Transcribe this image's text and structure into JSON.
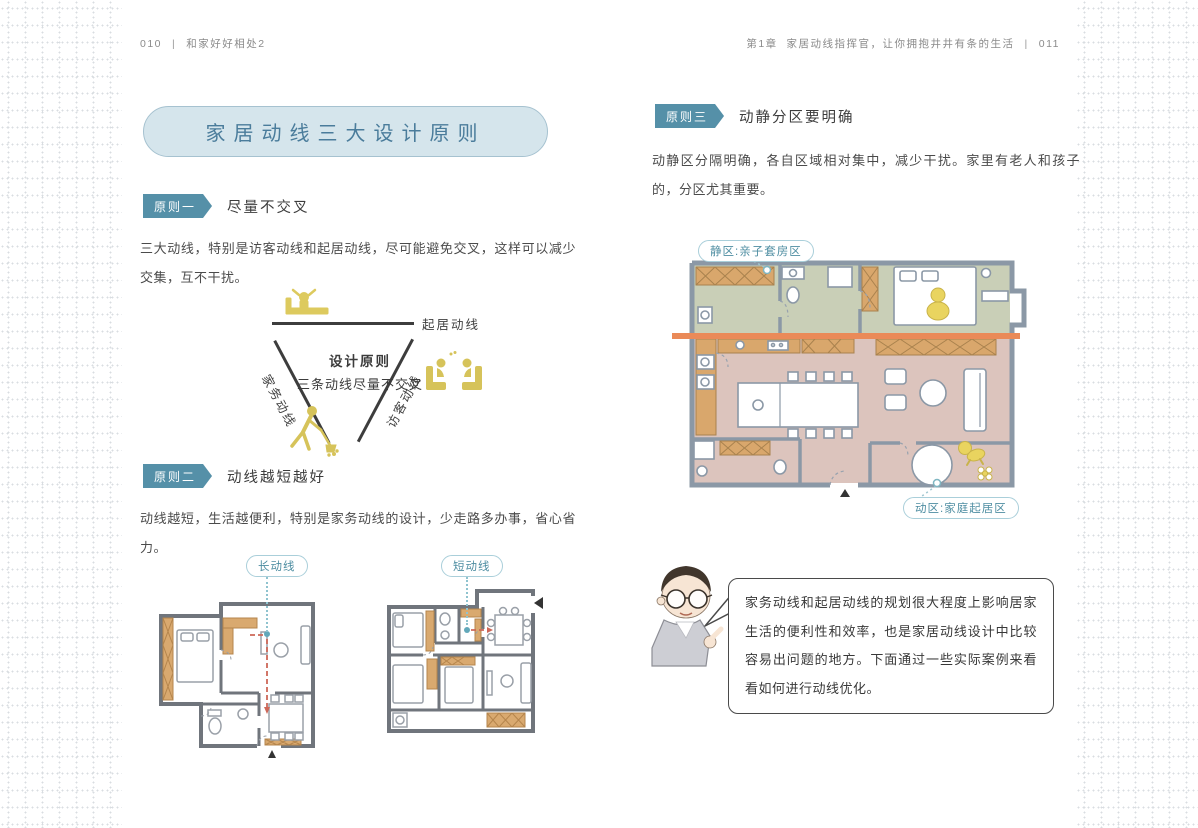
{
  "colors": {
    "accent_teal": "#5590a8",
    "title_bubble_fill": "#d5e5ec",
    "title_text": "#4a7c9b",
    "tag_teal": "#4f8ea2",
    "orange_divider": "#ea8a58",
    "quiet_zone_green": "#c9cfb7",
    "active_zone_pink": "#dcc4bd",
    "route_red": "#cd6758",
    "figure_yellow": "#ddca5e",
    "furniture_tan": "#d9a96f",
    "wall_gray": "#8b98a6"
  },
  "left_page": {
    "header": {
      "page_num": "010",
      "separator": "|",
      "book_title": "和家好好相处2"
    },
    "title": "家居动线三大设计原则",
    "sections": [
      {
        "badge": "原则一",
        "title": "尽量不交叉",
        "body": "三大动线，特别是访客动线和起居动线，尽可能避免交叉，这样可以减少交集，互不干扰。"
      },
      {
        "badge": "原则二",
        "title": "动线越短越好",
        "body": "动线越短，生活越便利，特别是家务动线的设计，少走路多办事，省心省力。"
      }
    ],
    "triangle_diagram": {
      "top_label": "起居动线",
      "left_label": "家务动线",
      "right_label": "访客动线",
      "center_title": "设计原则",
      "center_subtitle": "三条动线尽量不交叉"
    },
    "floorplans": [
      {
        "label": "长动线"
      },
      {
        "label": "短动线"
      }
    ]
  },
  "right_page": {
    "header": {
      "chapter": "第1章",
      "chapter_title": "家居动线指挥官，让你拥抱井井有条的生活",
      "separator": "|",
      "page_num": "011"
    },
    "section": {
      "badge": "原则三",
      "title": "动静分区要明确",
      "body": "动静区分隔明确，各自区域相对集中，减少干扰。家里有老人和孩子的，分区尤其重要。"
    },
    "zoning_plan": {
      "quiet_label": "静区:亲子套房区",
      "active_label": "动区:家庭起居区"
    },
    "advisor_speech": "家务动线和起居动线的规划很大程度上影响居家生活的便利性和效率，也是家居动线设计中比较容易出问题的地方。下面通过一些实际案例来看看如何进行动线优化。"
  }
}
